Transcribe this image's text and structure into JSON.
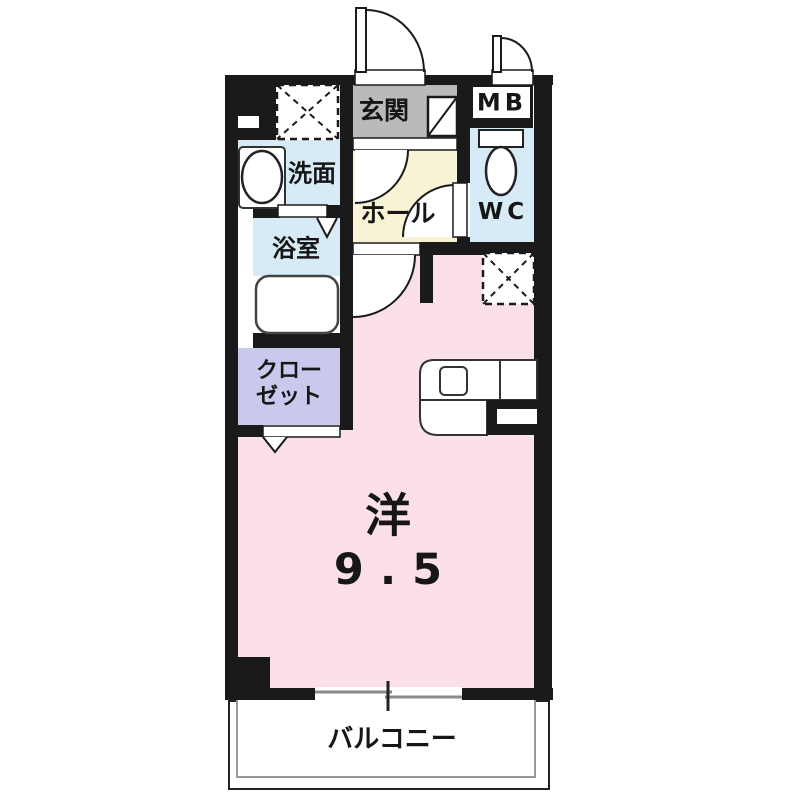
{
  "floorplan": {
    "rooms": {
      "genkan": {
        "label": "玄関"
      },
      "hall": {
        "label": "ホール"
      },
      "washroom": {
        "label": "洗面"
      },
      "bathroom": {
        "label": "浴室"
      },
      "wc": {
        "label": "WC"
      },
      "meter_box": {
        "label": "MB"
      },
      "closet": {
        "label_line1": "クロー",
        "label_line2": "ゼット"
      },
      "main_room": {
        "label": "洋",
        "size": "9.5"
      },
      "balcony": {
        "label": "バルコニー"
      }
    },
    "fixtures": {
      "washing_machine_space": "dashed-x-square",
      "refrigerator_space": "dashed-x-square",
      "shoe_cabinet": "box-with-diagonal",
      "sink": "oval-basin",
      "toilet": "tank-and-bowl",
      "bathtub": "rounded-rectangle",
      "kitchen_counter": "counter-with-stove",
      "balcony_window": "sliding-double-line",
      "doors": [
        "entrance-swing",
        "mb-swing",
        "hall-swing",
        "wc-swing",
        "room-swing",
        "bathroom-folding",
        "closet-folding"
      ]
    },
    "colors": {
      "wall": "#1a1a1a",
      "genkan_floor": "#bababa",
      "hall_floor": "#f8f3d4",
      "wet_area_floor": "#d6ebf6",
      "closet_floor": "#c9c9ee",
      "main_room_floor": "#fbdfe9",
      "balcony_floor": "#ffffff"
    }
  }
}
